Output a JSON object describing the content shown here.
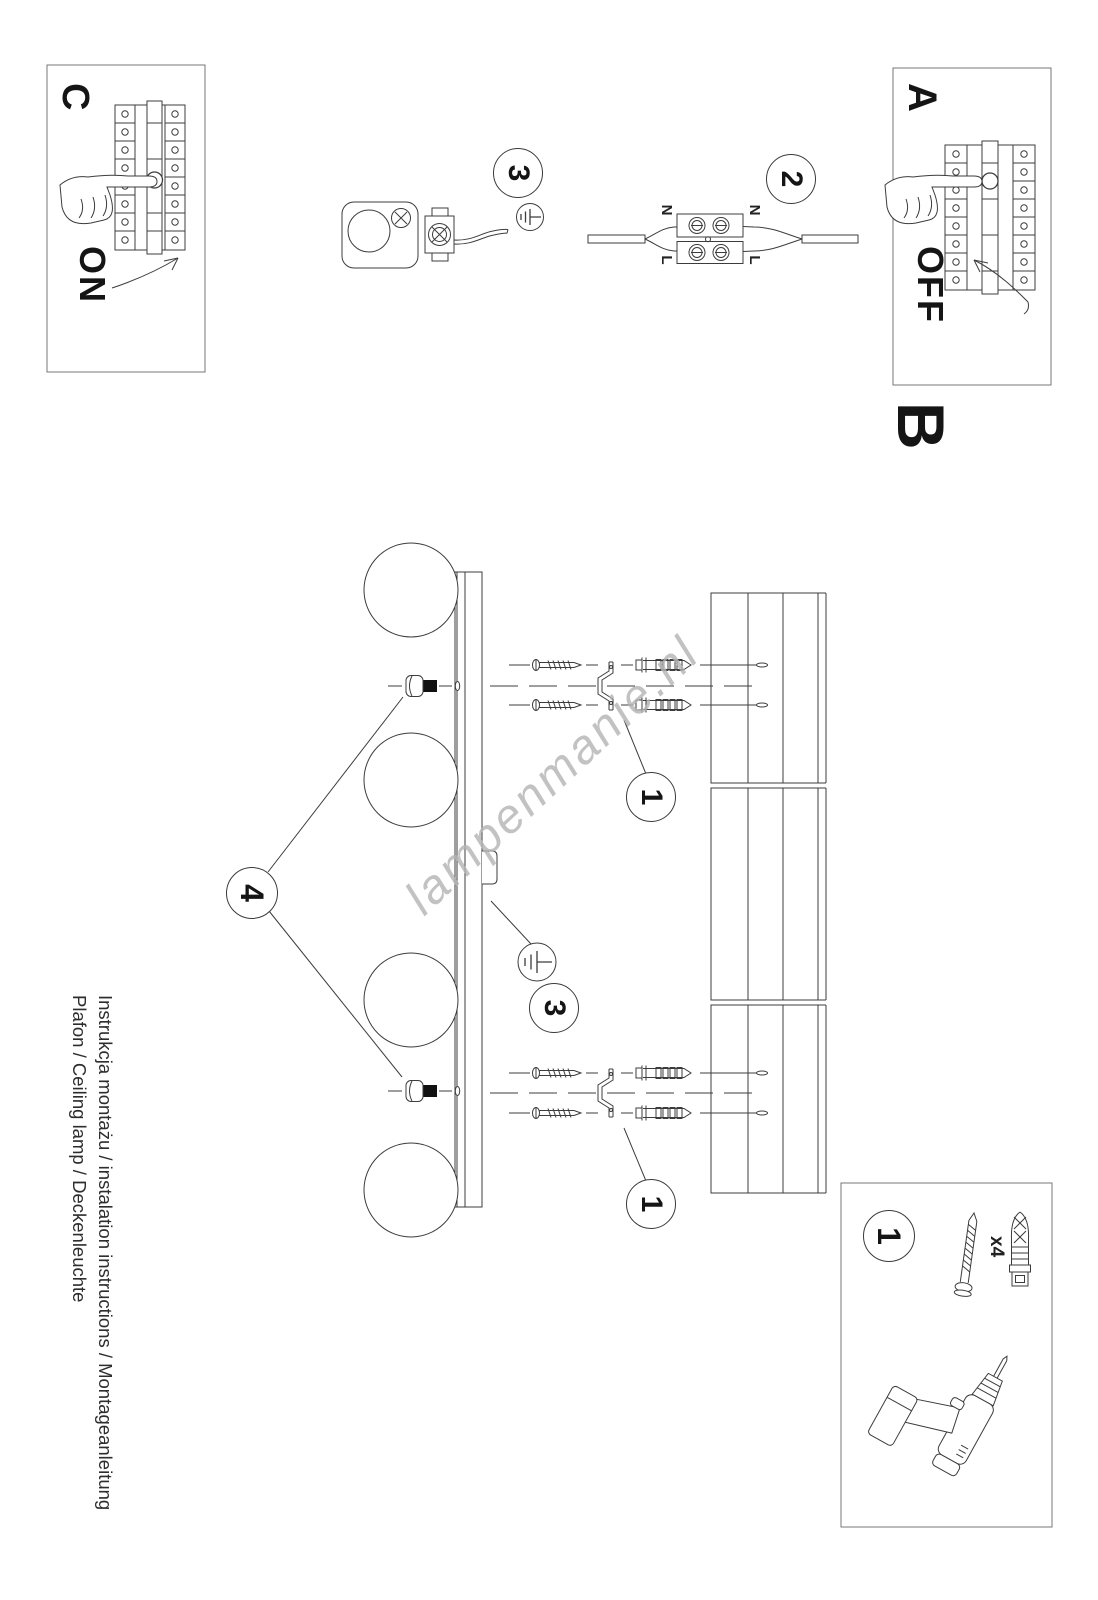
{
  "watermark": {
    "text": "lampenmanie.nl"
  },
  "title": {
    "line1": "Instrukcja montażu / instalation instructions / Montageanleitung",
    "line2": "Plafon / Ceiling lamp / Deckenleuchte"
  },
  "sections": {
    "a_label": "A",
    "b_label": "B",
    "c_label": "C",
    "off_text": "OFF",
    "on_text": "ON"
  },
  "callouts": {
    "step1": "1",
    "step2": "2",
    "step3": "3",
    "step4": "4"
  },
  "wiring": {
    "neutral": "N",
    "live": "L"
  },
  "hardware": {
    "quantity": "x4"
  },
  "colors": {
    "ink": "#3c3c3c",
    "box_border": "#777777",
    "text": "#151515",
    "watermark": "#b4b4b4"
  }
}
